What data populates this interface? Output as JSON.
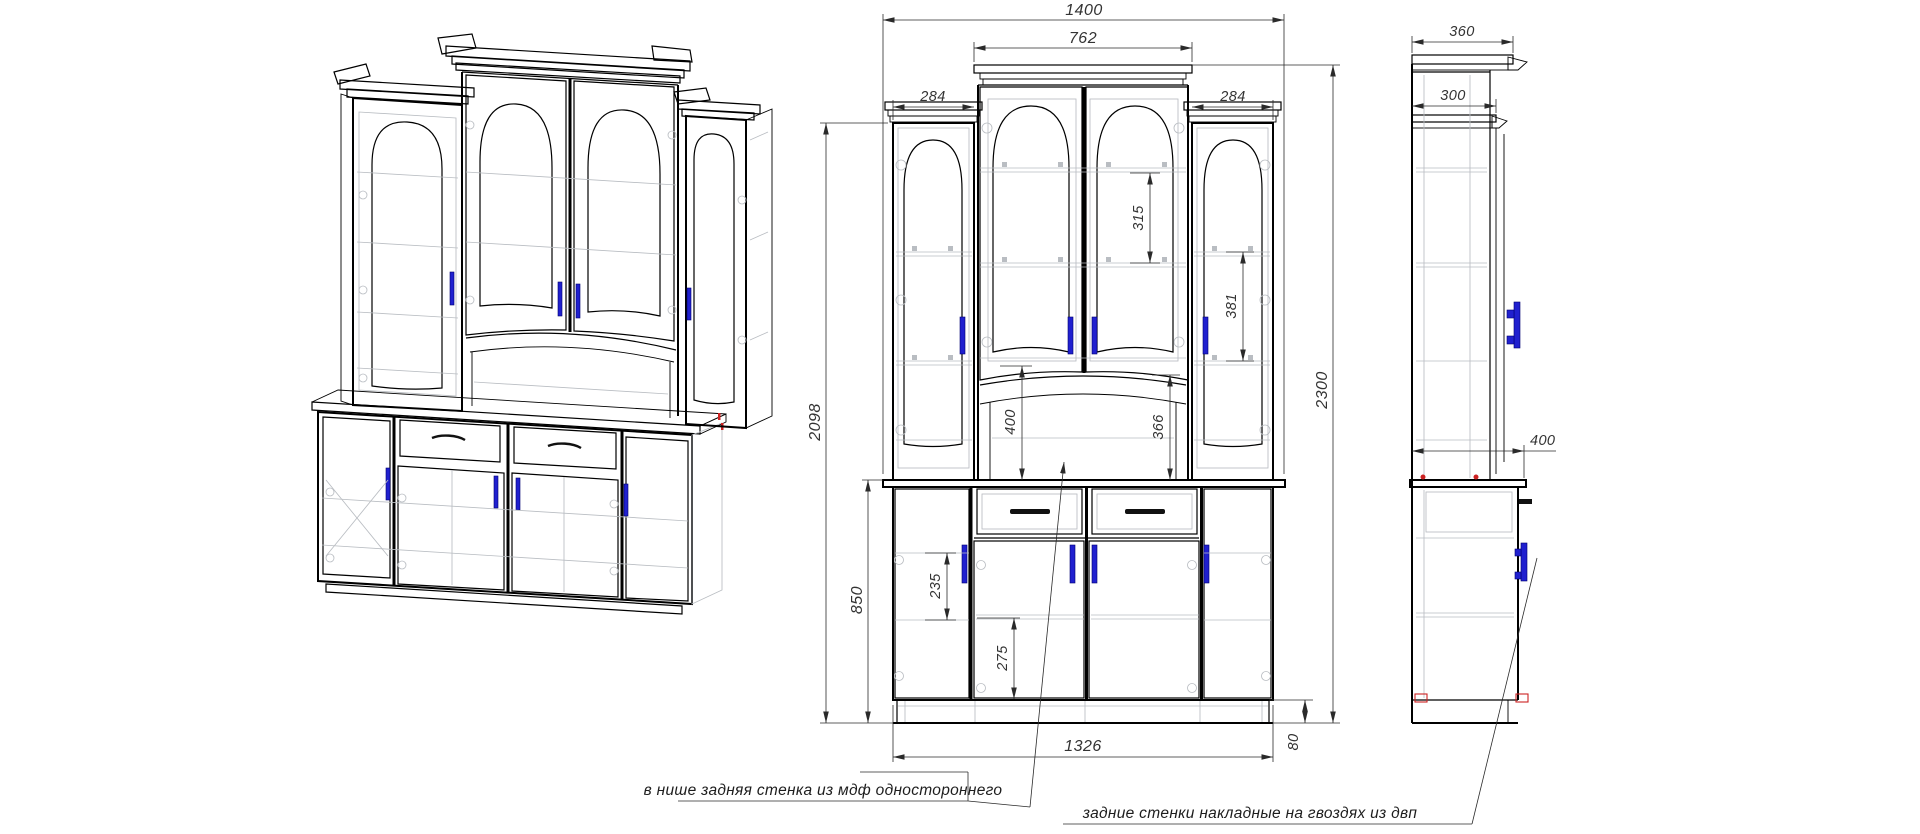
{
  "drawing": {
    "dims_front": {
      "overall_width": "1400",
      "upper_center_width": "762",
      "left_tower_width": "284",
      "right_tower_width": "284",
      "upper_height": "2098",
      "total_height": "2300",
      "base_height": "850",
      "center_shelf_spacing": "315",
      "side_shelf_spacing": "381",
      "niche_height_left": "400",
      "niche_height_right": "366",
      "side_shelf_height": "235",
      "lower_shelf_height": "275",
      "carcass_width": "1326",
      "plinth_height": "80"
    },
    "dims_side": {
      "cornice_depth": "360",
      "upper_depth": "300",
      "lower_depth": "400"
    },
    "notes": {
      "niche_back": "в нише задняя стенка из мдф одностороннего",
      "rear_panels": "задние стенки накладные на гвоздях из двп"
    },
    "colors": {
      "line": "#000000",
      "hidden_line": "#b9bdc2",
      "handle_blue": "#2020cf",
      "accent_red": "#cc2222",
      "dim_text": "#333333"
    }
  }
}
